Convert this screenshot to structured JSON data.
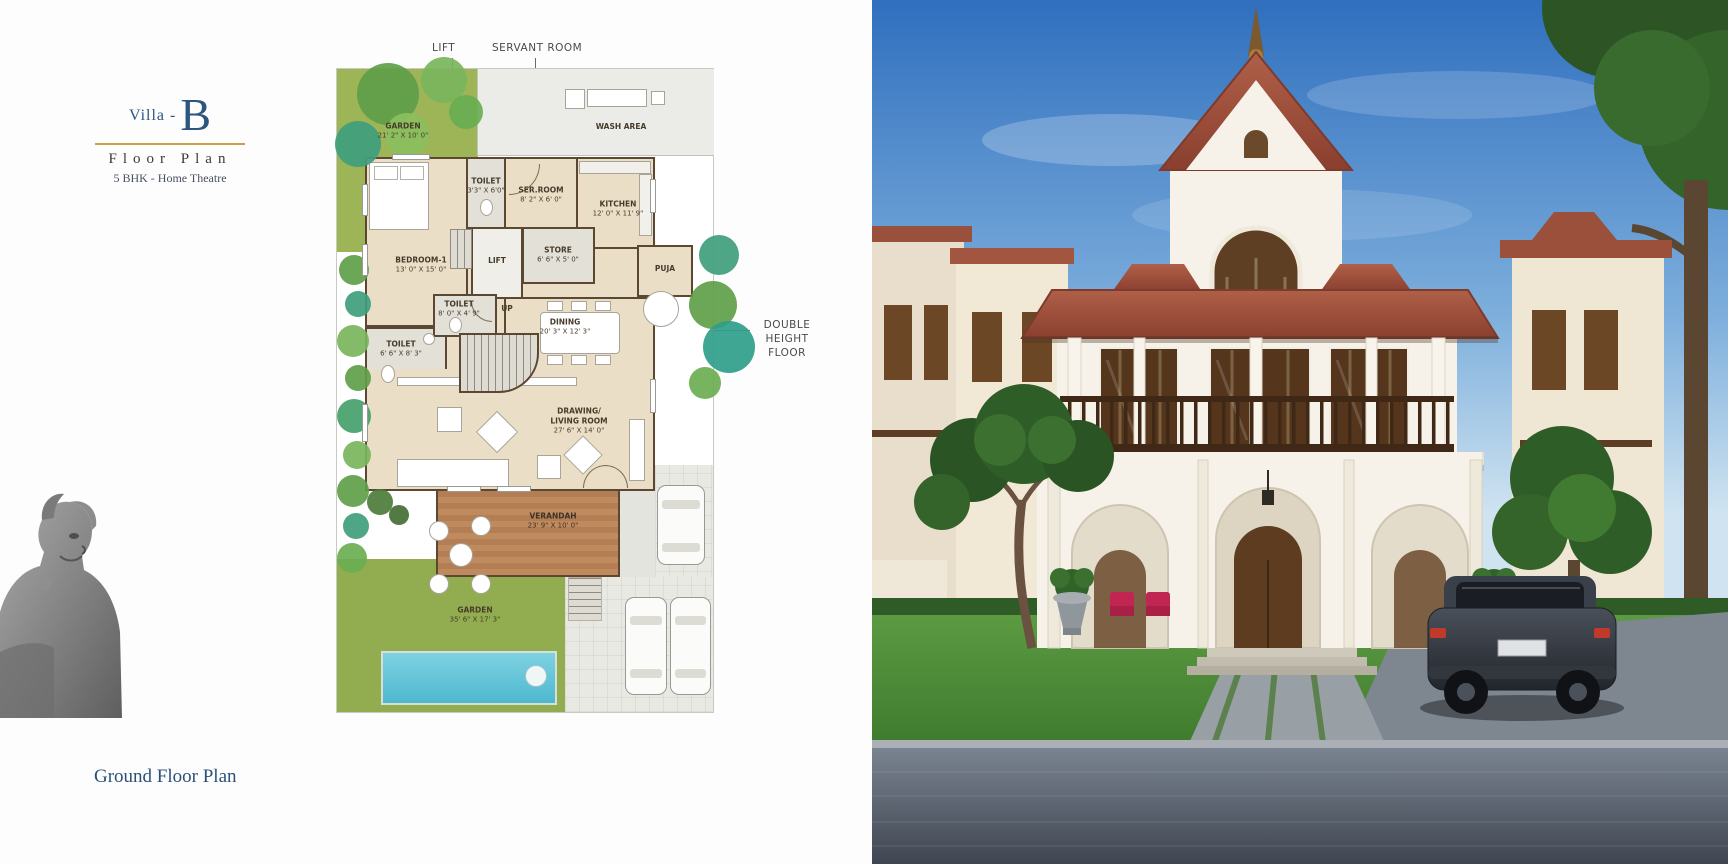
{
  "header": {
    "villa_prefix": "Villa -",
    "villa_letter": "B",
    "title": "Floor Plan",
    "subtitle": "5 BHK - Home Theatre"
  },
  "footer": {
    "caption": "Ground Floor Plan"
  },
  "callouts": {
    "lift": "LIFT",
    "servant_room": "SERVANT ROOM",
    "double_height_line1": "DOUBLE",
    "double_height_line2": "HEIGHT FLOOR"
  },
  "plan": {
    "rooms": {
      "garden_top": {
        "label": "GARDEN",
        "dims": "21' 2\" X 10' 0\""
      },
      "wash_area": {
        "label": "WASH AREA",
        "dims": ""
      },
      "toilet_top": {
        "label": "TOILET",
        "dims": "3'3\" X 6'0\""
      },
      "ser_room": {
        "label": "SER.ROOM",
        "dims": "8' 2\" X 6' 0\""
      },
      "kitchen": {
        "label": "KITCHEN",
        "dims": "12' 0\" X 11' 9\""
      },
      "store": {
        "label": "STORE",
        "dims": "6' 6\" X 5' 0\""
      },
      "lift": {
        "label": "LIFT",
        "dims": ""
      },
      "bedroom1": {
        "label": "BEDROOM-1",
        "dims": "13' 0\" X 15' 0\""
      },
      "toilet_mid": {
        "label": "TOILET",
        "dims": "8' 0\" X 4' 9\""
      },
      "toilet_left": {
        "label": "TOILET",
        "dims": "6' 6\" X 8' 3\""
      },
      "up": {
        "label": "UP",
        "dims": ""
      },
      "dining": {
        "label": "DINING",
        "dims": "20' 3\" X 12' 3\""
      },
      "puja": {
        "label": "PUJA",
        "dims": ""
      },
      "living": {
        "label": "DRAWING/ LIVING ROOM",
        "dims": "27' 6\" X 14' 0\""
      },
      "verandah": {
        "label": "VERANDAH",
        "dims": "23' 9\" X 10' 0\""
      },
      "garden_bottom": {
        "label": "GARDEN",
        "dims": "35' 6\" X 17' 3\""
      }
    }
  },
  "colors": {
    "navy": "#2c5580",
    "gold": "#c9a23f",
    "wall": "#5c4733",
    "grass": "#9db557"
  }
}
